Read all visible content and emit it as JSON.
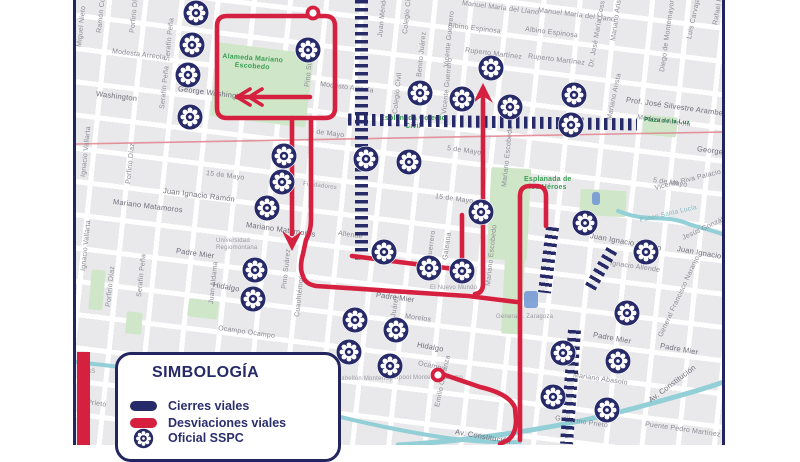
{
  "colors": {
    "navy": "#272a68",
    "red": "#d6203f",
    "map_bg": "#e9e9eb",
    "park_green": "#cfe6c8",
    "park_text_green": "#3d9e57",
    "river_teal": "#92cfd6",
    "label_gray": "#8b8b95"
  },
  "legend": {
    "title": "SIMBOLOGÍA",
    "items": [
      {
        "label": "Cierres viales",
        "swatch": "navy-bar"
      },
      {
        "label": "Desviaciones viales",
        "swatch": "red-bar"
      },
      {
        "label": "Oficial SSPC",
        "swatch": "officer-badge"
      }
    ]
  },
  "map": {
    "area_labels": [
      {
        "t": "Alameda Mariano\nEscobedo",
        "x": 222,
        "y": 58,
        "r": 4,
        "c": "green"
      },
      {
        "t": "Esplanada Colegio\nCivil",
        "x": 380,
        "y": 120,
        "r": 0,
        "c": "green"
      },
      {
        "t": "Esplanada de\nlos Héroes",
        "x": 524,
        "y": 181,
        "r": 0,
        "c": "green"
      },
      {
        "t": "Plaza de la Luz",
        "x": 644,
        "y": 122,
        "r": 4,
        "c": "dgreen"
      }
    ],
    "street_labels": [
      {
        "t": "Miguel Nieto",
        "x": 80,
        "y": 48,
        "r": -84
      },
      {
        "t": "Ramón Corona",
        "x": 100,
        "y": 34,
        "r": -84
      },
      {
        "t": "Porfirio Díaz",
        "x": 133,
        "y": 34,
        "r": -84
      },
      {
        "t": "Serafín Peña",
        "x": 168,
        "y": 62,
        "r": -84
      },
      {
        "t": "Serafín Peña",
        "x": 163,
        "y": 110,
        "r": -84
      },
      {
        "t": "Modesta Arreola",
        "x": 112,
        "y": 53,
        "r": 7
      },
      {
        "t": "Washington",
        "x": 96,
        "y": 95,
        "r": 7,
        "c": "d"
      },
      {
        "t": "George Washington",
        "x": 178,
        "y": 90,
        "r": 7,
        "c": "d"
      },
      {
        "t": "Ignacio Vallarta",
        "x": 84,
        "y": 178,
        "r": -84
      },
      {
        "t": "Ignacio Vallarta",
        "x": 84,
        "y": 272,
        "r": -84
      },
      {
        "t": "Porfirio Díaz",
        "x": 129,
        "y": 185,
        "r": -84
      },
      {
        "t": "Porfirio Díaz",
        "x": 109,
        "y": 308,
        "r": -84
      },
      {
        "t": "Serafín Peña",
        "x": 140,
        "y": 298,
        "r": -84
      },
      {
        "t": "Juan Aldama",
        "x": 212,
        "y": 305,
        "r": -84
      },
      {
        "t": "Pino Suárez",
        "x": 308,
        "y": 88,
        "r": -84
      },
      {
        "t": "Pino Suárez",
        "x": 285,
        "y": 290,
        "r": -84
      },
      {
        "t": "Cuauhtémoc",
        "x": 298,
        "y": 318,
        "r": -84
      },
      {
        "t": "Juan Méndez",
        "x": 381,
        "y": 38,
        "r": -84
      },
      {
        "t": "Colegio Civil",
        "x": 406,
        "y": 35,
        "r": -84
      },
      {
        "t": "Colegio Civil",
        "x": 396,
        "y": 115,
        "r": -84
      },
      {
        "t": "Benito Juárez",
        "x": 420,
        "y": 78,
        "r": -84
      },
      {
        "t": "Benito Juárez",
        "x": 390,
        "y": 341,
        "r": -80
      },
      {
        "t": "Vicente Guerrero",
        "x": 447,
        "y": 68,
        "r": -84
      },
      {
        "t": "Vicente Guerrero",
        "x": 445,
        "y": 115,
        "r": -84
      },
      {
        "t": "Guerrero",
        "x": 430,
        "y": 261,
        "r": -82
      },
      {
        "t": "Galeana",
        "x": 446,
        "y": 261,
        "r": -82
      },
      {
        "t": "Dr. José María Coss",
        "x": 592,
        "y": 68,
        "r": -80
      },
      {
        "t": "Mariano Arista",
        "x": 614,
        "y": 42,
        "r": -82
      },
      {
        "t": "Mariano Arista",
        "x": 610,
        "y": 121,
        "r": -78
      },
      {
        "t": "Diego de Montemayor",
        "x": 663,
        "y": 73,
        "r": -82
      },
      {
        "t": "Luis Carvajal",
        "x": 690,
        "y": 40,
        "r": -78
      },
      {
        "t": "Rafael Platón Sánchez",
        "x": 716,
        "y": 26,
        "r": -80
      },
      {
        "t": "Mariano Escobedo",
        "x": 505,
        "y": 188,
        "r": -84
      },
      {
        "t": "Mariano Escobedo",
        "x": 489,
        "y": 287,
        "r": -84
      },
      {
        "t": "Emilio Carranza",
        "x": 438,
        "y": 408,
        "r": -78
      },
      {
        "t": "Manuel María del Llano",
        "x": 462,
        "y": 5,
        "r": 7
      },
      {
        "t": "Manuel María del Llano",
        "x": 538,
        "y": 12,
        "r": 7
      },
      {
        "t": "Albino Espinosa",
        "x": 448,
        "y": 27,
        "r": 7
      },
      {
        "t": "Albino Espinosa",
        "x": 525,
        "y": 31,
        "r": 7
      },
      {
        "t": "Ruperto Martínez",
        "x": 465,
        "y": 52,
        "r": 7
      },
      {
        "t": "Ruperto Martínez",
        "x": 528,
        "y": 58,
        "r": 7
      },
      {
        "t": "Modesto Arreola",
        "x": 320,
        "y": 86,
        "r": 7
      },
      {
        "t": "Modesto Arreola",
        "x": 637,
        "y": 119,
        "r": 8
      },
      {
        "t": "Prof. José Silvestre Aramberri",
        "x": 626,
        "y": 101,
        "r": 8,
        "c": "d"
      },
      {
        "t": "George",
        "x": 697,
        "y": 150,
        "r": 8,
        "c": "d"
      },
      {
        "t": "5 de Mayo",
        "x": 310,
        "y": 133,
        "r": 7
      },
      {
        "t": "5 de Mayo",
        "x": 447,
        "y": 150,
        "r": 8
      },
      {
        "t": "5 de Mayo",
        "x": 653,
        "y": 182,
        "r": 8
      },
      {
        "t": "15 de Mayo",
        "x": 206,
        "y": 175,
        "r": 7
      },
      {
        "t": "15 de Mayo",
        "x": 435,
        "y": 198,
        "r": 8
      },
      {
        "t": "Juan Ignacio Ramón",
        "x": 163,
        "y": 192,
        "r": 7,
        "c": "d"
      },
      {
        "t": "Juan Ignacio Ramón",
        "x": 590,
        "y": 237,
        "r": 10,
        "c": "d"
      },
      {
        "t": "Juan Ignacio Ramón",
        "x": 677,
        "y": 250,
        "r": 10,
        "c": "d"
      },
      {
        "t": "Mariano Matamoros",
        "x": 113,
        "y": 203,
        "r": 7,
        "c": "d"
      },
      {
        "t": "Mariano Matamoros",
        "x": 246,
        "y": 226,
        "r": 8,
        "c": "d"
      },
      {
        "t": "Ignacio Allende",
        "x": 610,
        "y": 265,
        "r": 8
      },
      {
        "t": "Allende",
        "x": 338,
        "y": 235,
        "r": 8
      },
      {
        "t": "Jesús González",
        "x": 683,
        "y": 240,
        "r": -25
      },
      {
        "t": "Vicente Riva Palacio",
        "x": 655,
        "y": 190,
        "r": -14
      },
      {
        "t": "Paseo Santa Lucía",
        "x": 640,
        "y": 222,
        "r": -13,
        "c": "teal"
      },
      {
        "t": "Padre Mier",
        "x": 176,
        "y": 252,
        "r": 8,
        "c": "d"
      },
      {
        "t": "Padre Mier",
        "x": 376,
        "y": 296,
        "r": 8,
        "c": "d"
      },
      {
        "t": "Padre Mier",
        "x": 593,
        "y": 336,
        "r": 10,
        "c": "d"
      },
      {
        "t": "Padre Mier",
        "x": 660,
        "y": 347,
        "r": 10,
        "c": "d"
      },
      {
        "t": "Morelos",
        "x": 405,
        "y": 318,
        "r": 8
      },
      {
        "t": "Hidalgo",
        "x": 213,
        "y": 286,
        "r": 10,
        "c": "d"
      },
      {
        "t": "Hidalgo",
        "x": 417,
        "y": 346,
        "r": 10,
        "c": "d"
      },
      {
        "t": "Ocampo Ocampo",
        "x": 218,
        "y": 330,
        "r": 8
      },
      {
        "t": "Ocampo",
        "x": 418,
        "y": 365,
        "r": 12
      },
      {
        "t": "Mariano Abasolo",
        "x": 573,
        "y": 377,
        "r": 8
      },
      {
        "t": "Guillermo Prieto",
        "x": 555,
        "y": 420,
        "r": 8
      },
      {
        "t": "Prieto",
        "x": 87,
        "y": 404,
        "r": 8
      },
      {
        "t": "Av. Constitución",
        "x": 455,
        "y": 433,
        "r": 10,
        "c": "d"
      },
      {
        "t": "Av. Constitución",
        "x": 650,
        "y": 402,
        "r": -37,
        "c": "d"
      },
      {
        "t": "Puente Pedro Martínez",
        "x": 645,
        "y": 426,
        "r": 8
      },
      {
        "t": "General Francisco Naranjo",
        "x": 661,
        "y": 338,
        "r": -65
      },
      {
        "t": "Fundadores",
        "x": 303,
        "y": 186,
        "r": 7,
        "c": "tiny"
      },
      {
        "t": "Universidad\nRegiomontana",
        "x": 216,
        "y": 243,
        "r": 0,
        "c": "tiny"
      },
      {
        "t": "El Nuevo Mundo",
        "x": 430,
        "y": 290,
        "r": 0,
        "c": "tiny"
      },
      {
        "t": "General I. Zaragoza",
        "x": 496,
        "y": 319,
        "r": 0,
        "c": "tiny"
      },
      {
        "t": "Pabellón Monterrey",
        "x": 337,
        "y": 381,
        "r": 0,
        "c": "tiny"
      },
      {
        "t": "Liverpool Monterrey Centro",
        "x": 385,
        "y": 380,
        "r": 0,
        "c": "tiny"
      },
      {
        "t": "IMSS",
        "x": 80,
        "y": 374,
        "r": 0,
        "c": "tiny"
      }
    ],
    "officers": [
      {
        "x": 196,
        "y": 13
      },
      {
        "x": 192,
        "y": 45
      },
      {
        "x": 188,
        "y": 75
      },
      {
        "x": 190,
        "y": 117
      },
      {
        "x": 308,
        "y": 50
      },
      {
        "x": 420,
        "y": 93
      },
      {
        "x": 462,
        "y": 99
      },
      {
        "x": 491,
        "y": 68
      },
      {
        "x": 510,
        "y": 107
      },
      {
        "x": 574,
        "y": 95
      },
      {
        "x": 571,
        "y": 125
      },
      {
        "x": 284,
        "y": 156
      },
      {
        "x": 282,
        "y": 182
      },
      {
        "x": 267,
        "y": 208
      },
      {
        "x": 366,
        "y": 159
      },
      {
        "x": 409,
        "y": 162
      },
      {
        "x": 481,
        "y": 212
      },
      {
        "x": 585,
        "y": 223
      },
      {
        "x": 384,
        "y": 252
      },
      {
        "x": 429,
        "y": 268
      },
      {
        "x": 462,
        "y": 271
      },
      {
        "x": 255,
        "y": 270
      },
      {
        "x": 253,
        "y": 299
      },
      {
        "x": 355,
        "y": 320
      },
      {
        "x": 396,
        "y": 330
      },
      {
        "x": 349,
        "y": 352
      },
      {
        "x": 390,
        "y": 366
      },
      {
        "x": 563,
        "y": 353
      },
      {
        "x": 618,
        "y": 361
      },
      {
        "x": 553,
        "y": 397
      },
      {
        "x": 607,
        "y": 410
      },
      {
        "x": 627,
        "y": 313
      },
      {
        "x": 646,
        "y": 252
      }
    ],
    "closures": [
      {
        "x": 355,
        "y": 0,
        "w": 13,
        "h": 262,
        "r": 0,
        "dir": "v"
      },
      {
        "x": 348,
        "y": 116,
        "w": 289,
        "h": 12,
        "r": 1,
        "dir": "h"
      },
      {
        "x": 542,
        "y": 227,
        "w": 13,
        "h": 66,
        "r": 7,
        "dir": "v"
      },
      {
        "x": 595,
        "y": 247,
        "w": 12,
        "h": 44,
        "r": 30,
        "dir": "v"
      },
      {
        "x": 564,
        "y": 330,
        "w": 13,
        "h": 114,
        "r": 4,
        "dir": "v"
      }
    ],
    "detours": {
      "paths": [
        "M313,16 L227,16 Q217,16 217,26 L217,108 Q217,118 227,118 L325,118 Q335,118 335,108 L335,26 Q335,16 325,16 L313,16",
        "M310,97 L237,97",
        "M292,118 L292,234",
        "M311,118 L311,220 Q311,231 306,240 L303,254 Q299,268 303,276 Q305,284 316,286 L468,296 L517,302",
        "M483,97 L483,284 Q483,293 475,294",
        "M520,440 L520,196 Q520,186 530,186 L536,186 Q546,186 546,196 L546,226",
        "M352,256 L462,270 L462,215",
        "M445,375 L480,387 Q510,394 515,408 L516,420 Q516,434 508,440 L500,444"
      ],
      "arrow_heads": [
        "M483,83 L473,103 L483,96 L493,103 Z",
        "M292,251 L282,231 L292,238 L302,231 Z"
      ],
      "chevrons": [
        "M250,89 L237,97 L250,105",
        "M262,89 L249,97 L262,105"
      ],
      "nodes": [
        {
          "x": 313,
          "y": 13
        },
        {
          "x": 438,
          "y": 375
        }
      ]
    },
    "rivers": [
      {
        "d": "M618,211 C648,223 662,214 686,223 C702,229 714,230 724,235",
        "w": 4
      },
      {
        "d": "M76,362 C130,368 170,372 215,384 C275,400 330,416 390,428 C450,440 480,443 520,442",
        "w": 4
      },
      {
        "d": "M398,445 C470,441 560,428 635,408 C675,397 705,389 726,381",
        "w": 5
      }
    ],
    "metro_line": {
      "d": "M76,144 L723,132",
      "w": 1.6
    },
    "parks": [
      {
        "x": 214,
        "y": 48,
        "w": 96,
        "h": 74,
        "r": 7
      },
      {
        "x": 489,
        "y": 168,
        "w": 40,
        "h": 92,
        "r": 3
      },
      {
        "x": 503,
        "y": 258,
        "w": 20,
        "h": 76,
        "r": 3
      },
      {
        "x": 643,
        "y": 116,
        "w": 34,
        "h": 20,
        "r": 5
      },
      {
        "x": 580,
        "y": 190,
        "w": 46,
        "h": 26,
        "r": 3
      },
      {
        "x": 90,
        "y": 270,
        "w": 14,
        "h": 40,
        "r": 5
      },
      {
        "x": 126,
        "y": 312,
        "w": 16,
        "h": 22,
        "r": 5
      },
      {
        "x": 188,
        "y": 300,
        "w": 30,
        "h": 18,
        "r": 7
      }
    ],
    "buildings": [
      {
        "x": 524,
        "y": 291,
        "w": 14,
        "h": 17
      },
      {
        "x": 592,
        "y": 192,
        "w": 8,
        "h": 13
      }
    ]
  }
}
